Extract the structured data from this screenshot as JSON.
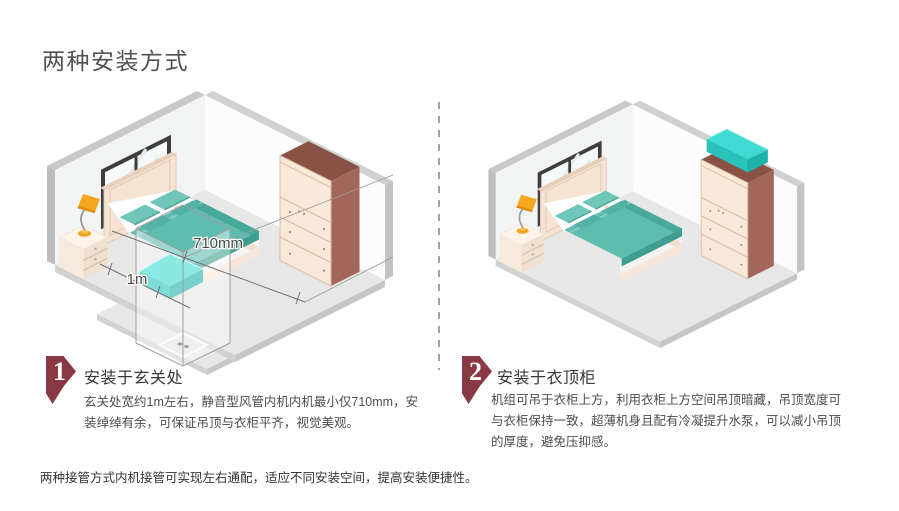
{
  "title": "两种安装方式",
  "methods": [
    {
      "number": "1",
      "heading": "安装于玄关处",
      "body": "玄关处宽约1m左右，静音型风管内机内机最小仅710mm，安装绰绰有余，可保证吊顶与衣柜平齐，视觉美观。"
    },
    {
      "number": "2",
      "heading": "安装于衣顶柜",
      "body": "机组可吊于衣柜上方，利用衣柜上方空间吊顶暗藏，吊顶宽度可与衣柜保持一致，超薄机身且配有冷凝提升水泵，可以减小吊顶的厚度，避免压抑感。"
    }
  ],
  "footnote": "两种接管方式内机接管可实现左右通配，适应不同安装空间，提高安装便捷性。",
  "annotations": {
    "unit_width": "710mm",
    "entry_width": "1m"
  },
  "colors": {
    "accent": "#8a3842",
    "teal_top": "#3fdbd3",
    "teal_side": "#1cb1a9",
    "wood": "#a2665a",
    "cream": "#f8e8da",
    "divider_dash": "#ab9d9d",
    "title_text": "#515151",
    "body_text": "#4c4c4c"
  }
}
